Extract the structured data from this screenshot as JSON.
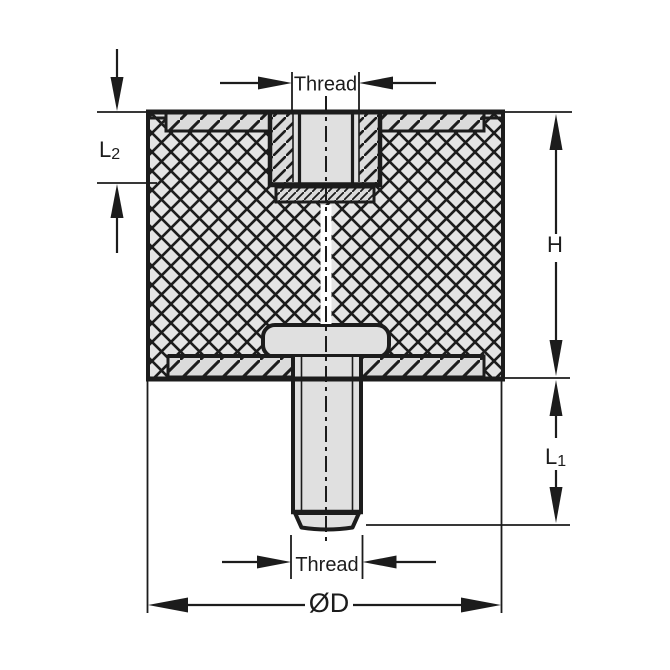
{
  "figure": {
    "labels": {
      "thread_top": "Thread",
      "thread_bottom": "Thread",
      "height": "H",
      "l1_main": "L",
      "l1_sub": "1",
      "l2_main": "L",
      "l2_sub": "2",
      "diameter": "ØD"
    },
    "colors": {
      "line": "#1c1c1c",
      "rubber-fill": "#e4e4e4",
      "metal-fill": "#dbdbdb",
      "bore-fill": "#e0e0e0",
      "background": "#ffffff"
    }
  }
}
